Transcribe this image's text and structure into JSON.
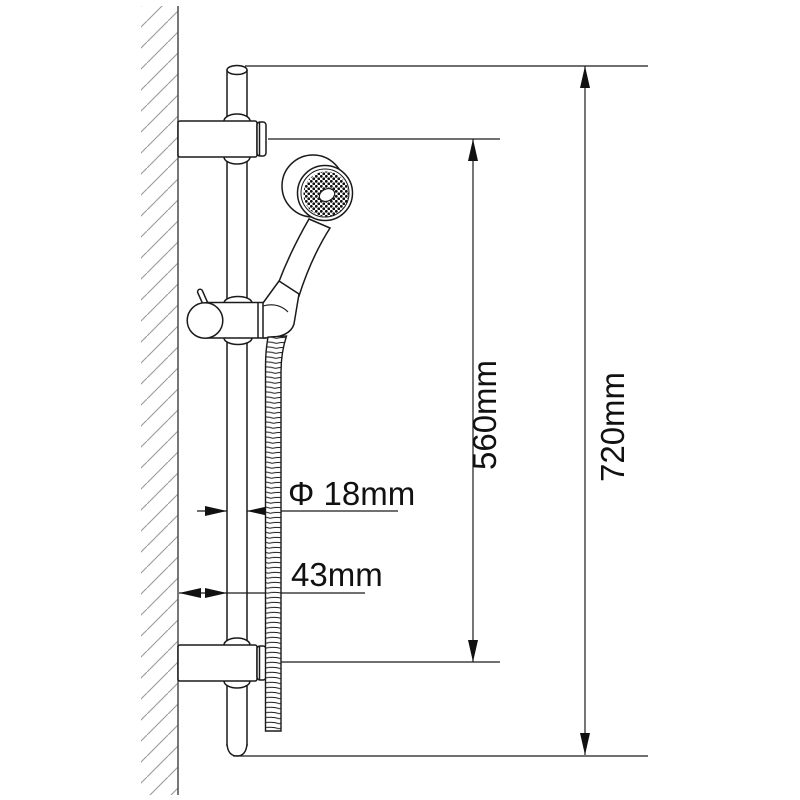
{
  "diagram": {
    "type": "technical-drawing",
    "subject": "wall-mounted shower slide bar with hand shower",
    "labels": {
      "bracket_span": "560mm",
      "overall_height": "720mm",
      "rail_diameter": "Φ 18mm",
      "wall_offset": "43mm"
    },
    "colors": {
      "line": "#1a1a1a",
      "wall_line": "#555555",
      "hatch": "#999999",
      "background": "#ffffff"
    }
  }
}
